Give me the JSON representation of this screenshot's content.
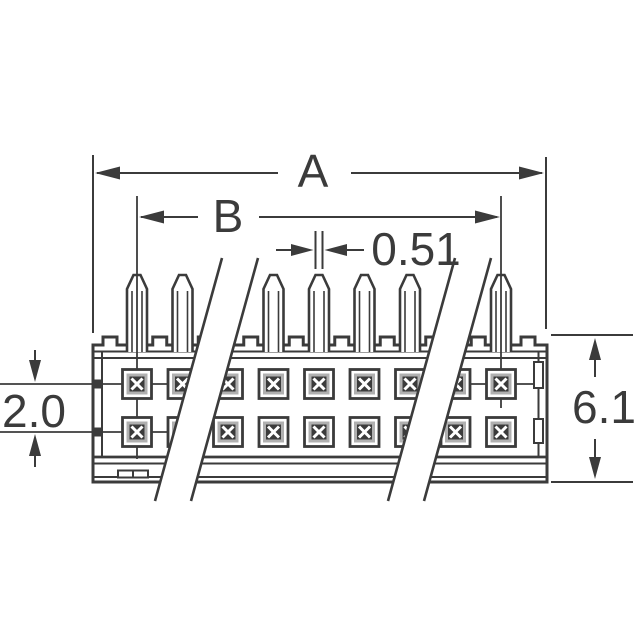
{
  "drawing": {
    "description": "connector-pin-header-technical-drawing",
    "labels": {
      "dim_overall_width": "A",
      "dim_pin_span": "B",
      "dim_pin_tip_width": "0.51",
      "dim_row_pitch": "2.0",
      "dim_body_height": "6.1"
    },
    "component": {
      "visible_pins": 7,
      "contact_rows": 2,
      "contact_columns": 9,
      "break_bands": 2
    },
    "colors": {
      "line": "#3b3b3b",
      "background": "#ffffff",
      "contact_ring": "#b0b0b0",
      "contact_center": "#3b3b3b",
      "x_mark": "#ffffff"
    }
  }
}
